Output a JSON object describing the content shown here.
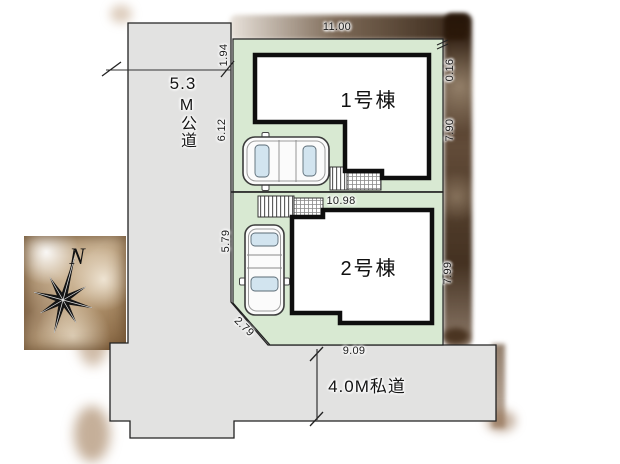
{
  "site_plan": {
    "compass": {
      "north_label": "N"
    },
    "public_road": {
      "width_value": "5.3",
      "name": "M公道"
    },
    "private_road": {
      "label": "4.0M私道"
    },
    "buildings": [
      {
        "label": "1号棟"
      },
      {
        "label": "2号棟"
      }
    ],
    "dimensions": {
      "lot1_top": "11.00",
      "lot1_left_upper": "1.94",
      "lot1_left_lower": "6.12",
      "lot1_right_upper": "0.16",
      "lot1_right_lower": "7.90",
      "lot_boundary": "10.98",
      "lot2_left": "5.79",
      "lot2_right": "7.99",
      "lot2_corner_diagonal": "2.79",
      "lot2_bottom": "9.09"
    },
    "colors": {
      "lot_green": "#d8e9d2",
      "road_gray": "#e2e2e1",
      "shadow_brown": "#3a2410"
    }
  }
}
